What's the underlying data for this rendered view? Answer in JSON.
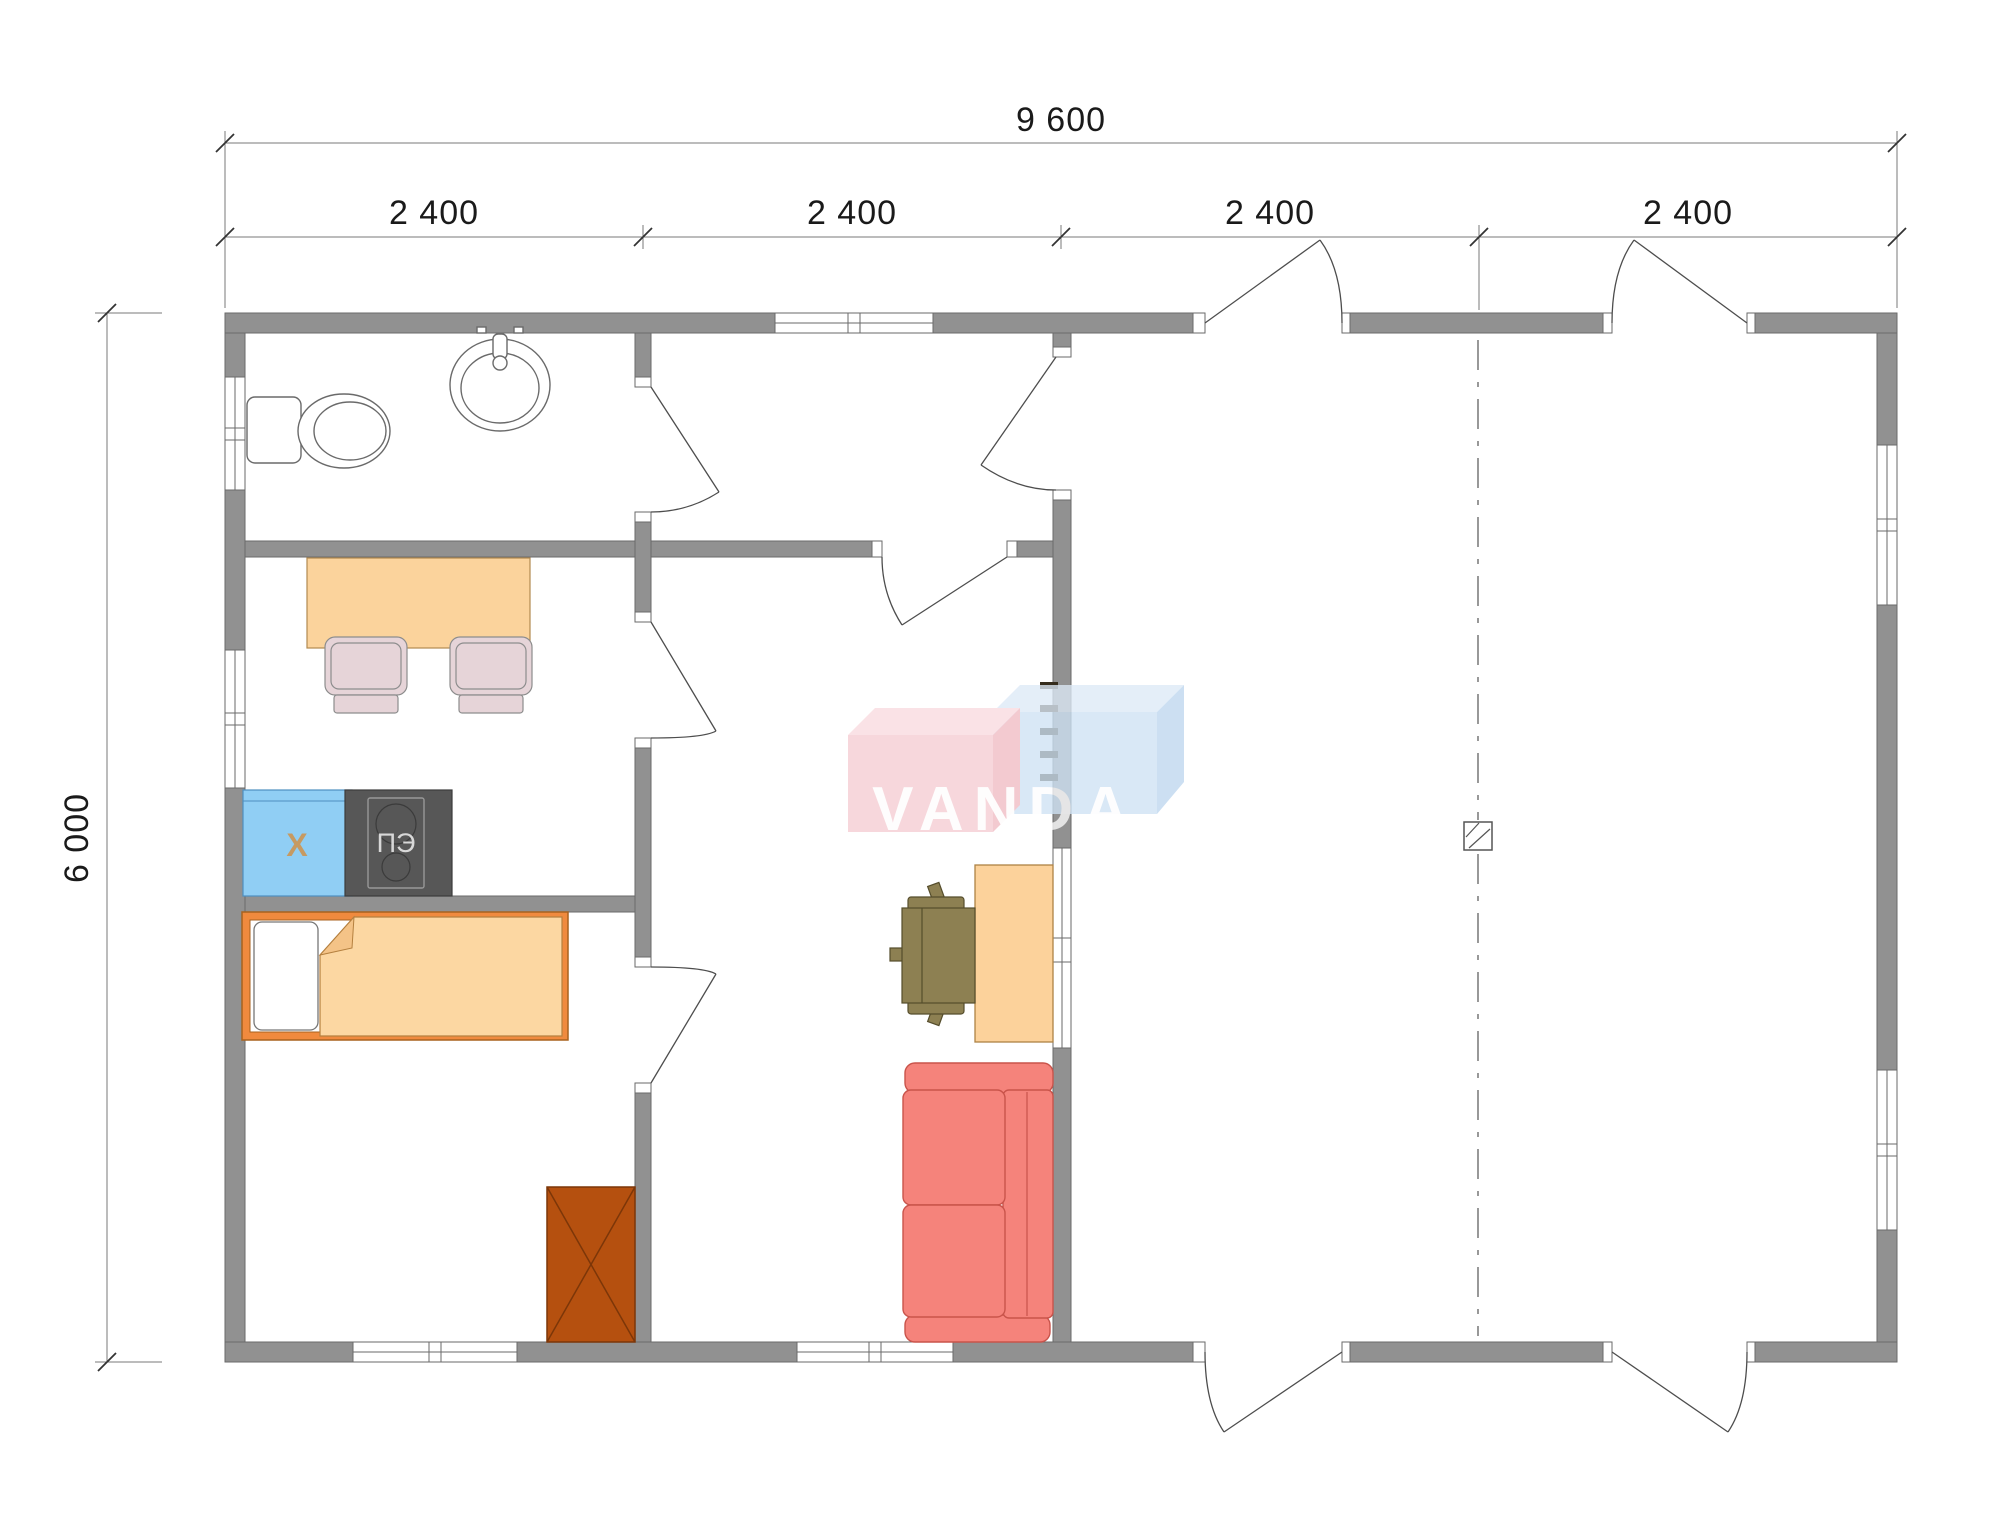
{
  "dimensions": {
    "total_width": "9 600",
    "bay": "2 400",
    "height": "6 000"
  },
  "labels": {
    "fridge": "Х",
    "stove": "ПЭ"
  },
  "logo": {
    "text": "VANDA"
  },
  "colors": {
    "wall": "#919191",
    "wall_line": "#6a6a6a",
    "line": "#4d4d4d",
    "axis": "#555555",
    "dim_line": "#7a7a7a",
    "dim_text": "#1a1a1a",
    "fixture_line": "#6a6a6a",
    "table": "#fbd39c",
    "table_line": "#b28a50",
    "chair": "#e6d4d8",
    "chair_line": "#8d8d8d",
    "fridge": "#90cef4",
    "fridge_line": "#4e8fc0",
    "stove": "#575757",
    "stove_line": "#3c3c3c",
    "stove_text": "#d8d8d8",
    "oven_line": "#989898",
    "bed_frame": "#f08a3e",
    "bed_line": "#a8621f",
    "blanket": "#fcd7a2",
    "blanket_fold": "#f4c387",
    "blanket_line": "#b5803f",
    "wardrobe": "#b5500f",
    "wardrobe_line": "#7c3608",
    "desk": "#fcd29b",
    "desk_line": "#ad8245",
    "ochair": "#8d8052",
    "ochair_line": "#554d2c",
    "sofa": "#f5837b",
    "sofa_line": "#c9544b",
    "radiator": "#352c1c",
    "x_text": "#c69a62",
    "logo_pink": "#f6cdd3",
    "logo_pink_top": "#f9dbe0",
    "logo_pink_side": "#f0bcc4",
    "logo_blue": "#cfe2f4",
    "logo_blue_top": "#ddeaf7",
    "logo_blue_side": "#bed7ef",
    "logo_text": "#ffffff"
  }
}
